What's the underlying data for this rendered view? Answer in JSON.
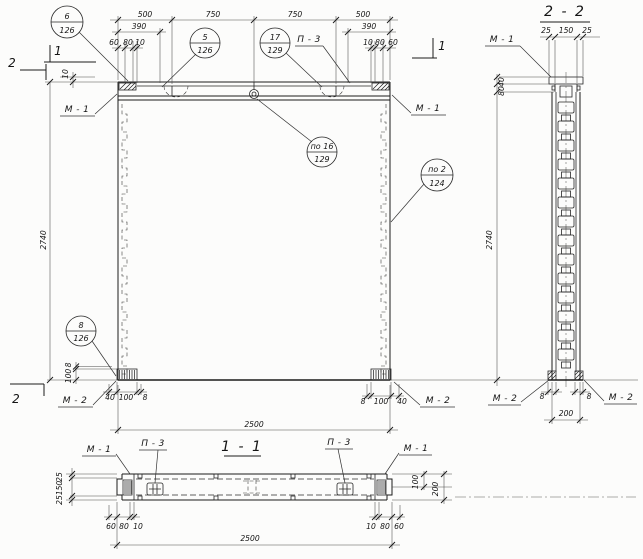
{
  "titles": {
    "section_2_2": "2 - 2",
    "section_1_1": "1 - 1"
  },
  "cut_markers": {
    "one": "1",
    "two": "2"
  },
  "labels": {
    "m1": "М - 1",
    "m2": "М - 2",
    "p3": "П - 3"
  },
  "balloons": {
    "b6": {
      "num": "6",
      "sheet": "126"
    },
    "b5": {
      "num": "5",
      "sheet": "126"
    },
    "b17": {
      "num": "17",
      "sheet": "129"
    },
    "b16": {
      "num": "по 16",
      "sheet": "129"
    },
    "b2": {
      "num": "по 2",
      "sheet": "124"
    },
    "b8": {
      "num": "8",
      "sheet": "126"
    }
  },
  "dims": {
    "elevation": {
      "top": [
        "500",
        "750",
        "750",
        "500"
      ],
      "offset_left": "390",
      "offset_right": "390",
      "sub_left": [
        "60",
        "80",
        "10"
      ],
      "sub_right": [
        "10",
        "80",
        "60"
      ],
      "height": "2740",
      "top_gap": "10",
      "pad_left": [
        "40",
        "100",
        "8"
      ],
      "pad_right": [
        "8",
        "100",
        "40"
      ],
      "pad_vert": [
        "8",
        "100"
      ],
      "width": "2500"
    },
    "section22": {
      "top": [
        "25",
        "150",
        "25"
      ],
      "head": [
        "40",
        "80"
      ],
      "height": "2740",
      "base_left": "8",
      "base_right": "8",
      "width": "200"
    },
    "section11": {
      "left": [
        "25",
        "150",
        "25"
      ],
      "bottom_left": [
        "60",
        "80",
        "10"
      ],
      "bottom_right": [
        "10",
        "80",
        "60"
      ],
      "right": [
        "100",
        "200"
      ],
      "width": "2500"
    }
  }
}
